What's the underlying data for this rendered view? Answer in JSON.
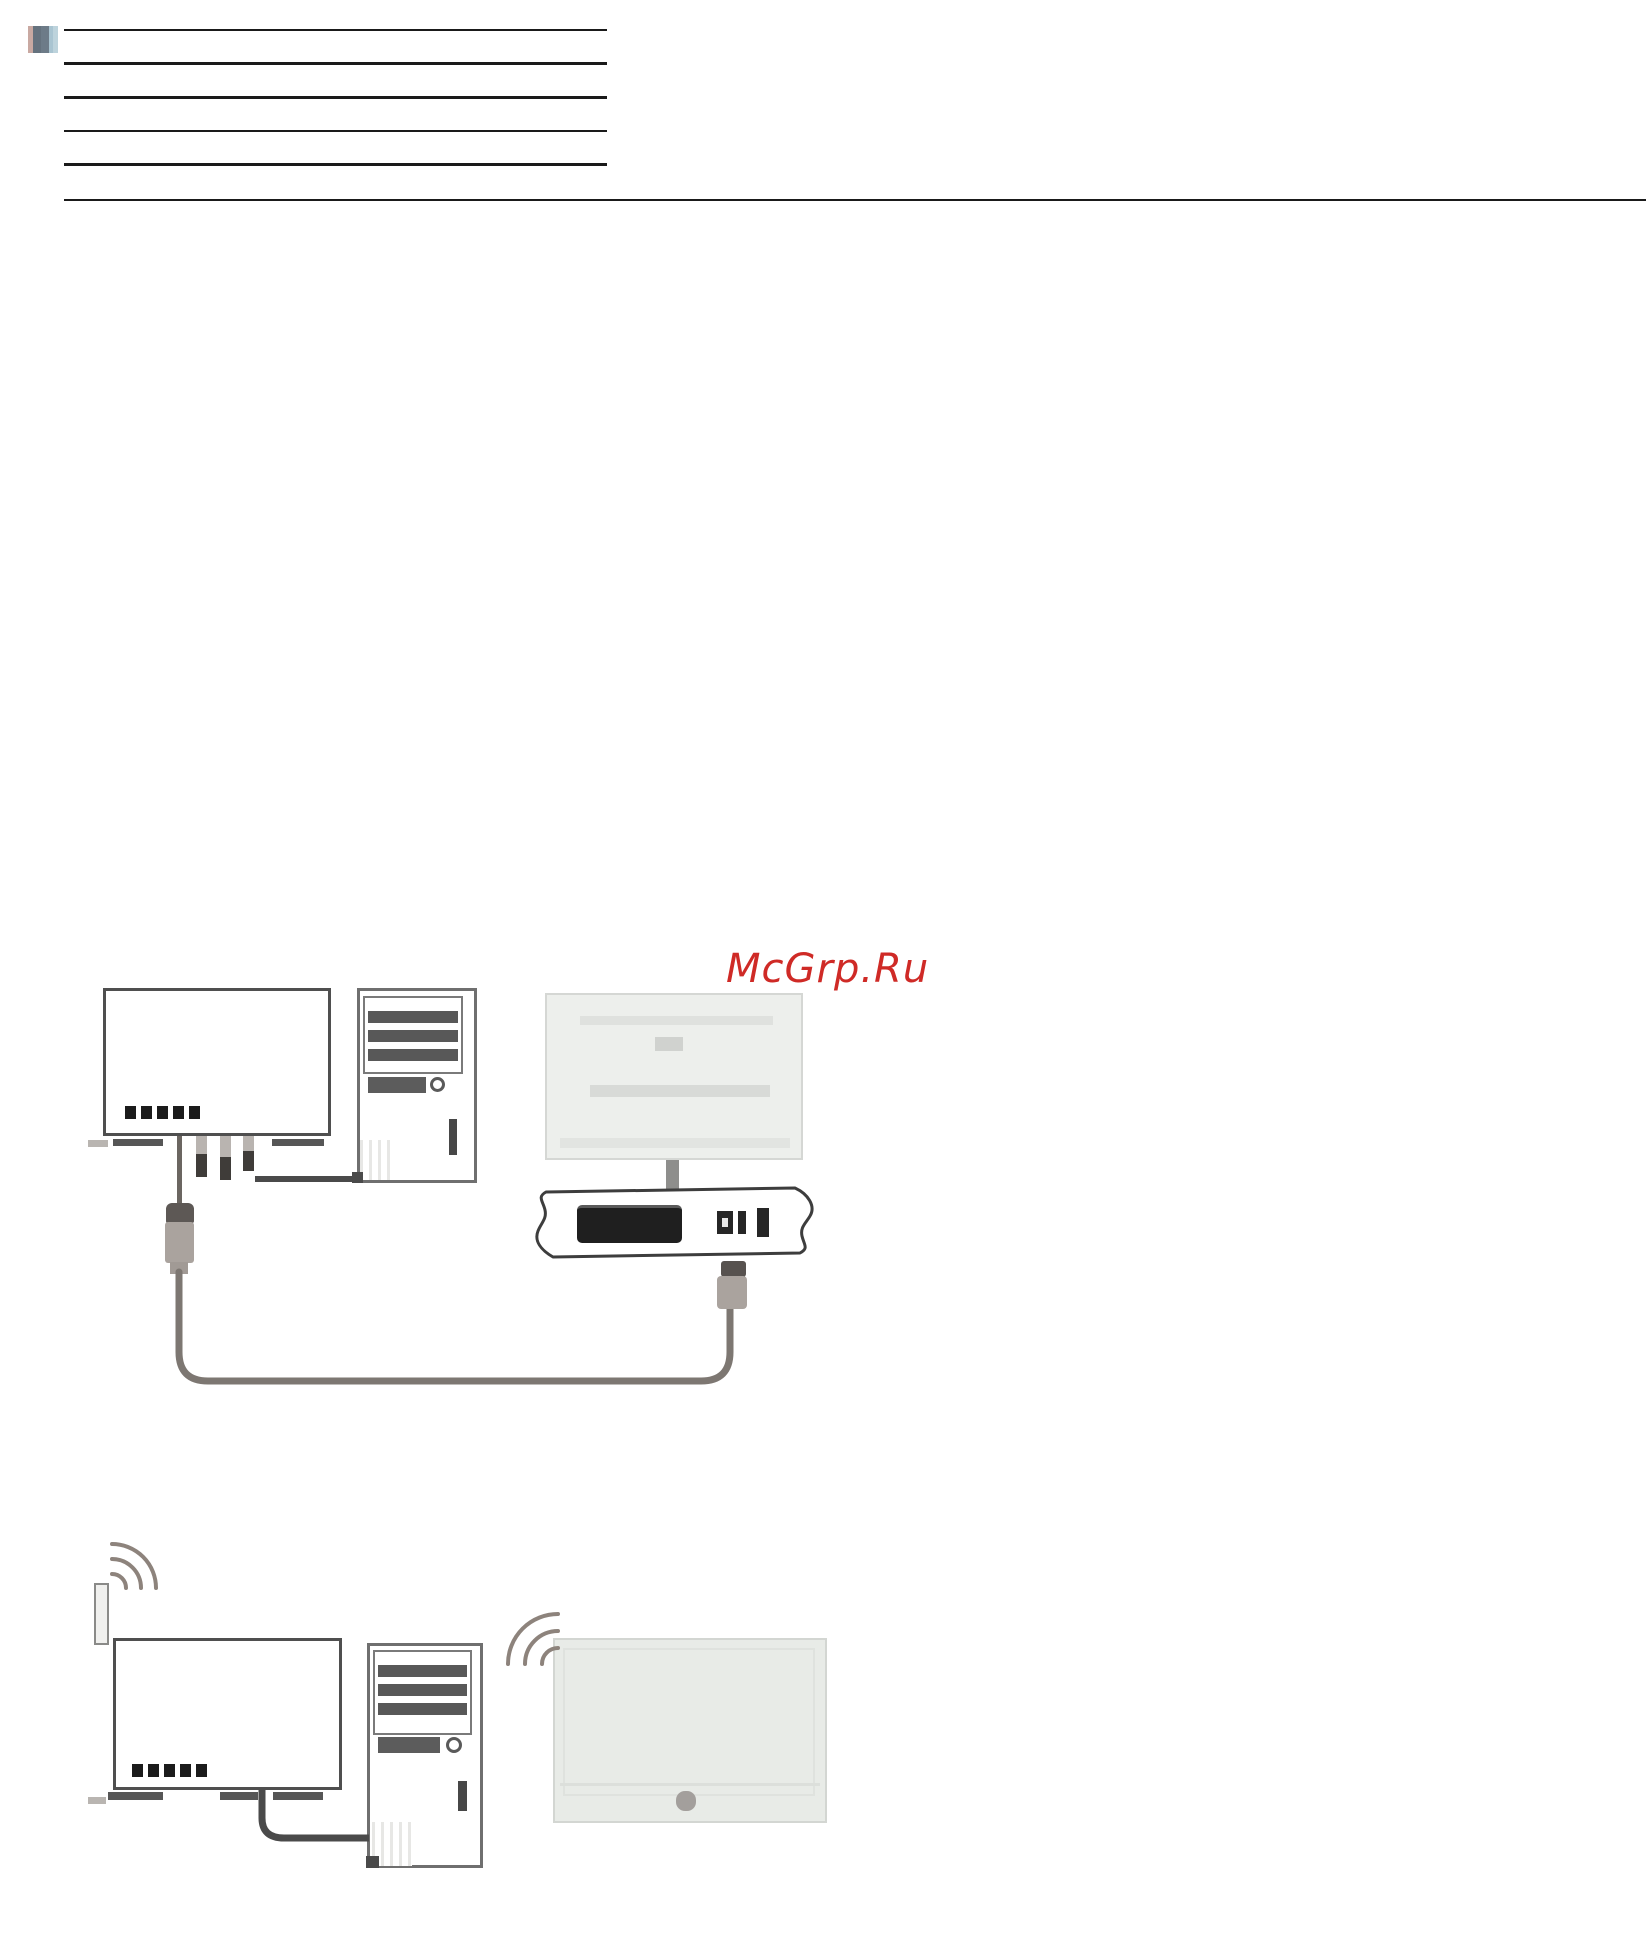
{
  "page": {
    "kind": "scanned manual page (network connection diagrams)",
    "background": "#ffffff"
  },
  "watermark": {
    "text": "McGrp.Ru",
    "color": "#cf2a26"
  },
  "header": {
    "icon": "page-thumbnail-icon",
    "short_rule_count": 5,
    "has_full_width_rule": true,
    "rule_color": "#1a1a1a"
  },
  "colors": {
    "device_stroke": "#4f4f4f",
    "pc_stroke": "#6f6f6f",
    "cable": "#7d7772",
    "plug_body": "#aaa39e",
    "tv_fill": "#e9ece8",
    "tv_stroke": "#d3d6d2",
    "port_dark": "#1f1f1f",
    "led": "#1b1b1b",
    "wireless_arc": "#8d837c"
  },
  "diagram_wired": {
    "name": "wired-network-connection-diagram",
    "devices": [
      {
        "name": "modem-router",
        "led_count": 5
      },
      {
        "name": "desktop-pc-tower"
      },
      {
        "name": "tv-rear-view-with-stand"
      },
      {
        "name": "one-connect-box",
        "ports": [
          "scart-port",
          "small-port",
          "slim-port",
          "vertical-port"
        ]
      }
    ],
    "connections": [
      "modem-to-pc-cable",
      "modem-plug-to-one-connect-plug-cable-loop",
      "tv-stand-into-one-connect-box"
    ]
  },
  "diagram_wireless": {
    "name": "wireless-network-connection-diagram",
    "devices": [
      {
        "name": "wireless-router",
        "led_count": 5,
        "antenna": true
      },
      {
        "name": "desktop-pc-tower"
      },
      {
        "name": "tv-front-view"
      }
    ],
    "connections": [
      "router-to-pc-cable",
      "wifi-signal-waves-at-router-antenna",
      "wifi-signal-waves-at-tv"
    ]
  }
}
